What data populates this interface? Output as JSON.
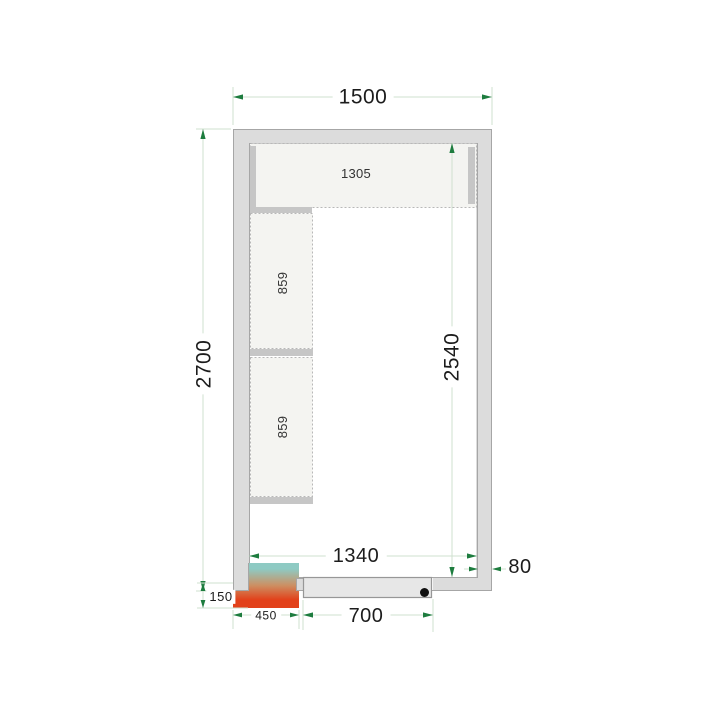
{
  "diagram": {
    "type": "cold-room-floor-plan-with-shelving"
  },
  "dimensions": {
    "outer_width_mm": "1500",
    "outer_depth_mm": "2700",
    "inner_width_mm": "1340",
    "inner_depth_mm": "2540",
    "wall_thickness_mm": "80",
    "door_width_mm": "700",
    "cooling_unit_width_mm": "450",
    "cooling_unit_protrusion_mm": "150"
  },
  "shelves": {
    "top_shelf_length_mm": "1305",
    "left_shelf_1_length_mm": "859",
    "left_shelf_2_length_mm": "859"
  },
  "colors": {
    "wall_fill": "#dcdcdc",
    "wall_stroke": "#a6a6a6",
    "shelf_fill": "#f4f4f1",
    "shelf_stroke": "#b8b8b8",
    "bracket_fill": "#c6c6c6",
    "dim_line": "#cfe0cf",
    "arrow": "#1d7c3e",
    "text": "#1c1c1c",
    "unit_gradient_top": "#8ecac3",
    "unit_gradient_mid": "#cd8f62",
    "unit_gradient_bottom": "#e2411a",
    "door_fill": "#e7e7e7",
    "handle": "#111111"
  }
}
